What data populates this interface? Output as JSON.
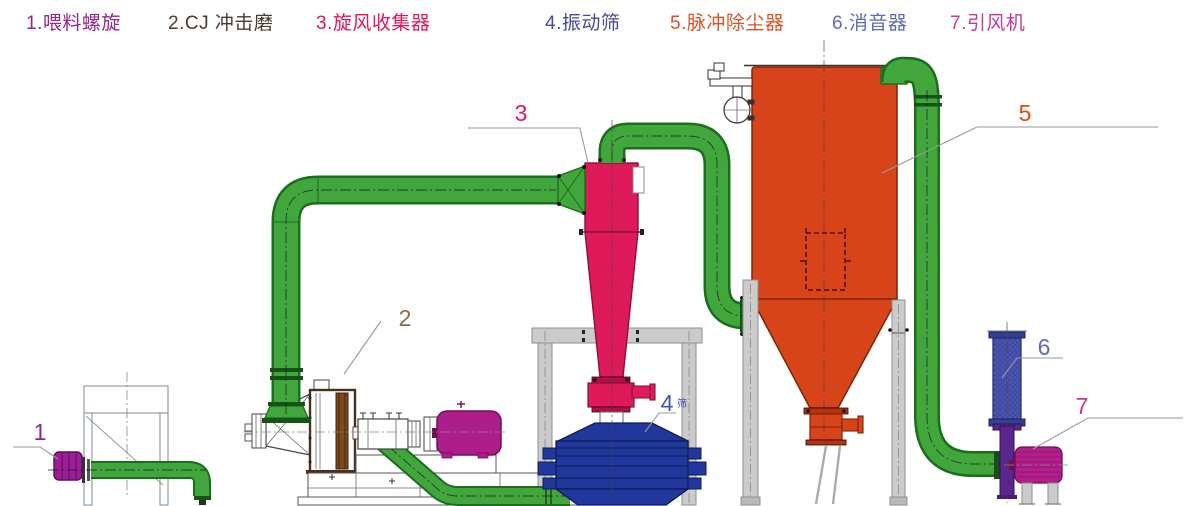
{
  "legend": {
    "items": [
      {
        "label": "1.喂料螺旋",
        "color": "#93278F"
      },
      {
        "label": "2.CJ 冲击磨",
        "color": "#4A3B30"
      },
      {
        "label": "3.旋风收集器",
        "color": "#E0175B"
      },
      {
        "label": "4.振动筛",
        "color": "#44499E"
      },
      {
        "label": "5.脉冲除尘器",
        "color": "#DC5226"
      },
      {
        "label": "6.消音器",
        "color": "#5E6BAD"
      },
      {
        "label": "7.引风机",
        "color": "#C2399A"
      }
    ]
  },
  "callouts": {
    "c1": {
      "n": "1",
      "color": "#93278F"
    },
    "c2": {
      "n": "2",
      "color": "#8C6A4A"
    },
    "c3": {
      "n": "3",
      "color": "#E0175B"
    },
    "c4": {
      "n": "4",
      "suffix": "筛",
      "color": "#3C56B8"
    },
    "c5": {
      "n": "5",
      "color": "#E04A18"
    },
    "c6": {
      "n": "6",
      "color": "#5E6BAD"
    },
    "c7": {
      "n": "7",
      "color": "#C2399A"
    }
  },
  "components": {
    "feed_screw_motor": {
      "color": "#9C1D96"
    },
    "mill_motor": {
      "color": "#AD1D8C"
    },
    "cyclone": {
      "color": "#DE1A5B"
    },
    "vibrating_screen": {
      "color": "#21379B"
    },
    "pulse_dust_collector": {
      "color": "#D8441A"
    },
    "muffler": {
      "color": "#4C57B5"
    },
    "exhaust_pipe": {
      "color": "#5B2590"
    },
    "induced_draft_fan": {
      "color": "#B21E8C"
    },
    "pipes": {
      "color": "#41A63C",
      "edge": "#1B6E1B"
    },
    "supports": {
      "color": "#CBCBCB"
    }
  }
}
